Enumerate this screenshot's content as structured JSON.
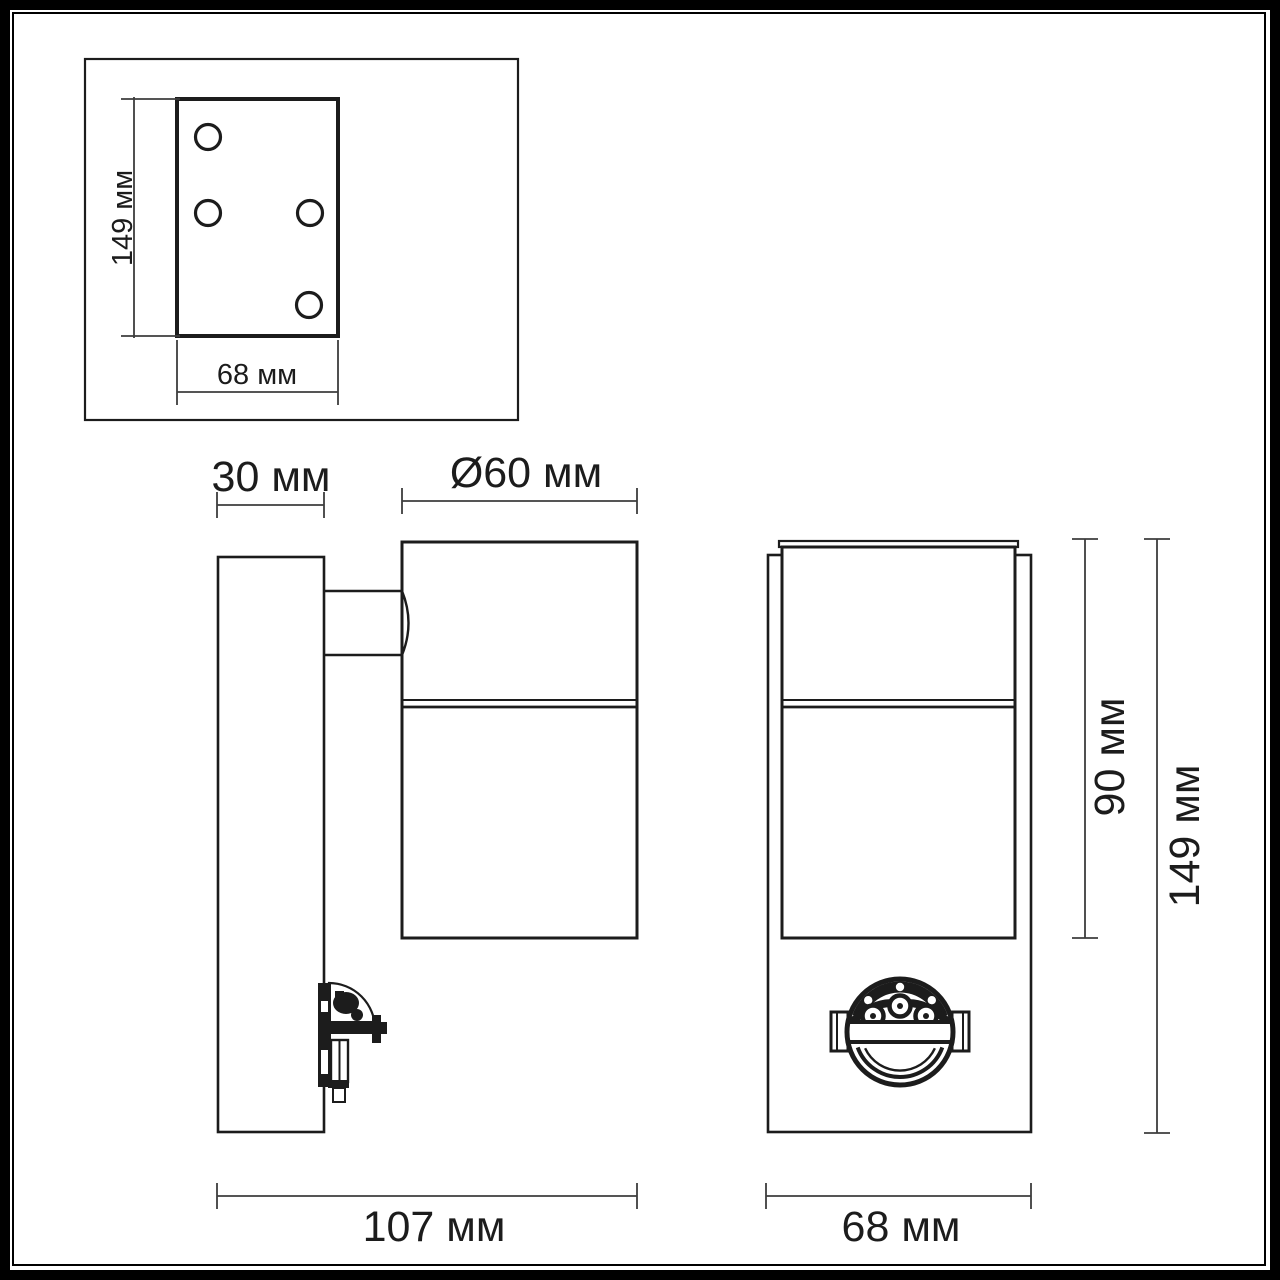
{
  "colors": {
    "line": "#1c1c1c",
    "dim": "#3d3d3d",
    "frame": "#000000",
    "background": "#ffffff"
  },
  "labels": {
    "inset_height": "149 мм",
    "inset_width": "68 мм",
    "side_plate_depth": "30 мм",
    "side_diameter": "Ø60 мм",
    "side_total_depth": "107 мм",
    "front_body_height": "90 мм",
    "front_total_height": "149 мм",
    "front_width": "68 мм"
  }
}
